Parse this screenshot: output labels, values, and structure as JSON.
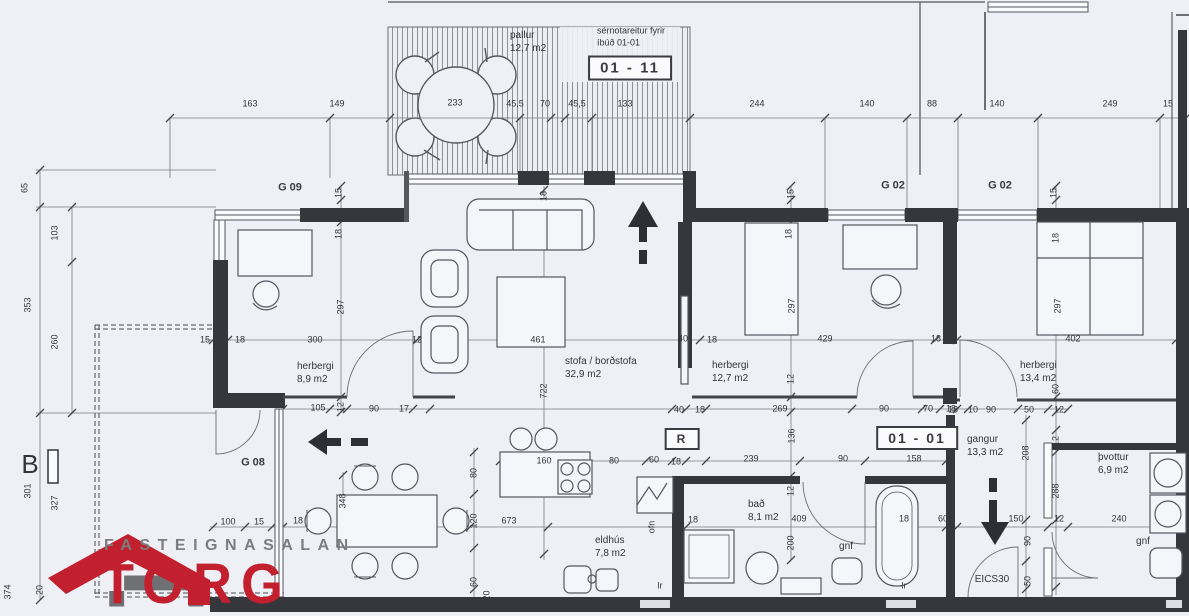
{
  "title": "Floor plan unit 01-01 / 01-11",
  "colors": {
    "paper": "#eef0f5",
    "ink": "#33343a",
    "wall": "#36373c",
    "thin": "#6b6e78",
    "red": "#c2202e",
    "gray": "#7c7d80"
  },
  "logo": {
    "name": "FASTEIGNASALAN",
    "brand": "TORG"
  },
  "deck": {
    "label": "pallur",
    "area": "12,7 m2",
    "note1": "sérnotareitur fyrir",
    "note2": "íbúð 01-01"
  },
  "badges": {
    "unit_top": "01 - 11",
    "unit_main": "01 - 01",
    "r_mark": "R"
  },
  "rooms": [
    {
      "name": "herbergi",
      "area": "8,9 m2"
    },
    {
      "name": "stofa / borðstofa",
      "area": "32,9 m2"
    },
    {
      "name": "herbergi",
      "area": "12,7 m2"
    },
    {
      "name": "herbergi",
      "area": "13,4 m2"
    },
    {
      "name": "eldhús",
      "area": "7,8 m2"
    },
    {
      "name": "bað",
      "area": "8,1 m2"
    },
    {
      "name": "gangur",
      "area": "13,3 m2"
    },
    {
      "name": "þvottur",
      "area": "6,9 m2"
    }
  ],
  "labels": [
    {
      "t": "pallur",
      "x": 510,
      "y": 36,
      "a": "left",
      "s": 10,
      "n": "deck-label"
    },
    {
      "t": "12,7 m2",
      "x": 510,
      "y": 49,
      "a": "left",
      "s": 10,
      "n": "deck-area"
    },
    {
      "t": "sérnotareitur fyrir",
      "x": 597,
      "y": 31,
      "a": "left",
      "n": "deck-note-line1"
    },
    {
      "t": "íbúð 01-01",
      "x": 597,
      "y": 43,
      "a": "left",
      "n": "deck-note-line2"
    },
    {
      "t": "01 - 11",
      "x": 630,
      "y": 68,
      "box": true,
      "s": 15,
      "b": true,
      "n": "unit-badge-01-11"
    },
    {
      "t": "233",
      "x": 455,
      "y": 103
    },
    {
      "t": "163",
      "x": 250,
      "y": 104
    },
    {
      "t": "149",
      "x": 337,
      "y": 104
    },
    {
      "t": "45,5",
      "x": 515,
      "y": 104
    },
    {
      "t": "70",
      "x": 545,
      "y": 104
    },
    {
      "t": "45,5",
      "x": 577,
      "y": 104
    },
    {
      "t": "133",
      "x": 625,
      "y": 104
    },
    {
      "t": "244",
      "x": 757,
      "y": 104
    },
    {
      "t": "140",
      "x": 867,
      "y": 104
    },
    {
      "t": "88",
      "x": 932,
      "y": 104
    },
    {
      "t": "140",
      "x": 997,
      "y": 104
    },
    {
      "t": "249",
      "x": 1110,
      "y": 104
    },
    {
      "t": "15",
      "x": 1168,
      "y": 104
    },
    {
      "t": "65",
      "x": 25,
      "y": 188,
      "r": true
    },
    {
      "t": "103",
      "x": 55,
      "y": 233,
      "r": true
    },
    {
      "t": "353",
      "x": 28,
      "y": 305,
      "r": true
    },
    {
      "t": "260",
      "x": 55,
      "y": 342,
      "r": true
    },
    {
      "t": "B",
      "x": 30,
      "y": 464,
      "s": 26,
      "n": "section-mark-b"
    },
    {
      "t": "301",
      "x": 28,
      "y": 491,
      "r": true
    },
    {
      "t": "327",
      "x": 55,
      "y": 503,
      "r": true
    },
    {
      "t": "374",
      "x": 8,
      "y": 592,
      "r": true
    },
    {
      "t": "20",
      "x": 40,
      "y": 590,
      "r": true
    },
    {
      "t": "120",
      "x": 487,
      "y": 598,
      "r": true
    },
    {
      "t": "G 09",
      "x": 290,
      "y": 188,
      "b": true,
      "s": 11,
      "n": "garden-label-g09"
    },
    {
      "t": "G 02",
      "x": 893,
      "y": 186,
      "b": true,
      "s": 11,
      "n": "garden-label-g02-a"
    },
    {
      "t": "G 02",
      "x": 1000,
      "y": 186,
      "b": true,
      "s": 11,
      "n": "garden-label-g02-b"
    },
    {
      "t": "G 08",
      "x": 253,
      "y": 463,
      "b": true,
      "s": 11,
      "n": "garden-label-g08"
    },
    {
      "t": "herbergi",
      "x": 297,
      "y": 367,
      "a": "left",
      "s": 10,
      "n": "room-label-herbergi-1"
    },
    {
      "t": "8,9 m2",
      "x": 297,
      "y": 380,
      "a": "left",
      "s": 10
    },
    {
      "t": "stofa / borðstofa",
      "x": 565,
      "y": 362,
      "a": "left",
      "s": 10,
      "n": "room-label-stofa"
    },
    {
      "t": "32,9 m2",
      "x": 565,
      "y": 375,
      "a": "left",
      "s": 10
    },
    {
      "t": "herbergi",
      "x": 712,
      "y": 366,
      "a": "left",
      "s": 10,
      "n": "room-label-herbergi-2"
    },
    {
      "t": "12,7 m2",
      "x": 712,
      "y": 379,
      "a": "left",
      "s": 10
    },
    {
      "t": "herbergi",
      "x": 1020,
      "y": 366,
      "a": "left",
      "s": 10,
      "n": "room-label-herbergi-3"
    },
    {
      "t": "13,4 m2",
      "x": 1020,
      "y": 379,
      "a": "left",
      "s": 10
    },
    {
      "t": "eldhús",
      "x": 595,
      "y": 541,
      "a": "left",
      "s": 10,
      "n": "room-label-eldhus"
    },
    {
      "t": "7,8 m2",
      "x": 595,
      "y": 554,
      "a": "left",
      "s": 10
    },
    {
      "t": "bað",
      "x": 748,
      "y": 505,
      "a": "left",
      "s": 10,
      "n": "room-label-bad"
    },
    {
      "t": "8,1 m2",
      "x": 748,
      "y": 518,
      "a": "left",
      "s": 10
    },
    {
      "t": "gangur",
      "x": 967,
      "y": 440,
      "a": "left",
      "s": 10,
      "n": "room-label-gangur"
    },
    {
      "t": "13,3 m2",
      "x": 967,
      "y": 453,
      "a": "left",
      "s": 10
    },
    {
      "t": "þvottur",
      "x": 1098,
      "y": 458,
      "a": "left",
      "s": 10,
      "n": "room-label-thvottur"
    },
    {
      "t": "6,9 m2",
      "x": 1098,
      "y": 471,
      "a": "left",
      "s": 10
    },
    {
      "t": "gnf",
      "x": 846,
      "y": 547,
      "s": 10,
      "n": "fixture-label-gnf-bath"
    },
    {
      "t": "gnf",
      "x": 1143,
      "y": 542,
      "s": 10,
      "n": "fixture-label-gnf-laundry"
    },
    {
      "t": "EICS30",
      "x": 992,
      "y": 580,
      "s": 10,
      "n": "door-spec-label"
    },
    {
      "t": "01 - 01",
      "x": 917,
      "y": 438,
      "box": true,
      "s": 14,
      "b": true,
      "n": "unit-badge-01-01"
    },
    {
      "t": "R",
      "x": 682,
      "y": 439,
      "box": true,
      "s": 12,
      "b": true,
      "n": "r-badge"
    },
    {
      "t": "ofn",
      "x": 652,
      "y": 527,
      "r": true,
      "n": "fixture-label-ofn"
    },
    {
      "t": "lr",
      "x": 660,
      "y": 586
    },
    {
      "t": "lr",
      "x": 904,
      "y": 586
    },
    {
      "t": "lr",
      "x": 1180,
      "y": 584,
      "r": true
    },
    {
      "t": "15",
      "x": 339,
      "y": 193,
      "r": true
    },
    {
      "t": "18",
      "x": 339,
      "y": 234,
      "r": true
    },
    {
      "t": "297",
      "x": 341,
      "y": 307,
      "r": true
    },
    {
      "t": "15",
      "x": 205,
      "y": 340
    },
    {
      "t": "18",
      "x": 240,
      "y": 340
    },
    {
      "t": "300",
      "x": 315,
      "y": 340
    },
    {
      "t": "12",
      "x": 417,
      "y": 340
    },
    {
      "t": "105",
      "x": 318,
      "y": 408
    },
    {
      "t": "12",
      "x": 341,
      "y": 407,
      "r": true
    },
    {
      "t": "90",
      "x": 374,
      "y": 409
    },
    {
      "t": "17",
      "x": 404,
      "y": 409
    },
    {
      "t": "18",
      "x": 544,
      "y": 196,
      "r": true
    },
    {
      "t": "461",
      "x": 538,
      "y": 340
    },
    {
      "t": "722",
      "x": 544,
      "y": 391,
      "r": true
    },
    {
      "t": "40",
      "x": 683,
      "y": 339
    },
    {
      "t": "15",
      "x": 791,
      "y": 194,
      "r": true
    },
    {
      "t": "18",
      "x": 789,
      "y": 234,
      "r": true
    },
    {
      "t": "297",
      "x": 792,
      "y": 306,
      "r": true
    },
    {
      "t": "18",
      "x": 712,
      "y": 340
    },
    {
      "t": "429",
      "x": 825,
      "y": 339
    },
    {
      "t": "18",
      "x": 936,
      "y": 339
    },
    {
      "t": "12",
      "x": 791,
      "y": 379,
      "r": true
    },
    {
      "t": "40",
      "x": 679,
      "y": 410
    },
    {
      "t": "18",
      "x": 700,
      "y": 410
    },
    {
      "t": "269",
      "x": 780,
      "y": 409
    },
    {
      "t": "90",
      "x": 884,
      "y": 409
    },
    {
      "t": "70",
      "x": 928,
      "y": 409
    },
    {
      "t": "18",
      "x": 951,
      "y": 409
    },
    {
      "t": "15",
      "x": 1054,
      "y": 193,
      "r": true
    },
    {
      "t": "18",
      "x": 1056,
      "y": 238,
      "r": true
    },
    {
      "t": "297",
      "x": 1058,
      "y": 306,
      "r": true
    },
    {
      "t": "402",
      "x": 1073,
      "y": 339
    },
    {
      "t": "60",
      "x": 1056,
      "y": 389,
      "r": true
    },
    {
      "t": "18",
      "x": 953,
      "y": 410
    },
    {
      "t": "10",
      "x": 973,
      "y": 410
    },
    {
      "t": "90",
      "x": 991,
      "y": 410
    },
    {
      "t": "50",
      "x": 1029,
      "y": 410
    },
    {
      "t": "12",
      "x": 1059,
      "y": 410
    },
    {
      "t": "100",
      "x": 228,
      "y": 522
    },
    {
      "t": "15",
      "x": 259,
      "y": 522
    },
    {
      "t": "18",
      "x": 298,
      "y": 521
    },
    {
      "t": "348",
      "x": 343,
      "y": 501,
      "r": true
    },
    {
      "t": "80",
      "x": 474,
      "y": 473,
      "r": true
    },
    {
      "t": "120",
      "x": 474,
      "y": 521,
      "r": true
    },
    {
      "t": "60",
      "x": 474,
      "y": 582,
      "r": true
    },
    {
      "t": "673",
      "x": 509,
      "y": 521
    },
    {
      "t": "160",
      "x": 544,
      "y": 461
    },
    {
      "t": "80",
      "x": 614,
      "y": 461
    },
    {
      "t": "60",
      "x": 654,
      "y": 460
    },
    {
      "t": "18",
      "x": 676,
      "y": 462
    },
    {
      "t": "18",
      "x": 693,
      "y": 520
    },
    {
      "t": "239",
      "x": 751,
      "y": 459
    },
    {
      "t": "90",
      "x": 843,
      "y": 459
    },
    {
      "t": "158",
      "x": 914,
      "y": 459
    },
    {
      "t": "136",
      "x": 792,
      "y": 436,
      "r": true
    },
    {
      "t": "12",
      "x": 791,
      "y": 491,
      "r": true
    },
    {
      "t": "409",
      "x": 799,
      "y": 519
    },
    {
      "t": "200",
      "x": 791,
      "y": 543,
      "r": true
    },
    {
      "t": "18",
      "x": 904,
      "y": 519
    },
    {
      "t": "60",
      "x": 943,
      "y": 519
    },
    {
      "t": "208",
      "x": 1026,
      "y": 453,
      "r": true
    },
    {
      "t": "12",
      "x": 1056,
      "y": 441,
      "r": true
    },
    {
      "t": "288",
      "x": 1056,
      "y": 491,
      "r": true
    },
    {
      "t": "150",
      "x": 1016,
      "y": 519
    },
    {
      "t": "12",
      "x": 1059,
      "y": 519
    },
    {
      "t": "240",
      "x": 1119,
      "y": 519
    },
    {
      "t": "90",
      "x": 1028,
      "y": 541,
      "r": true
    },
    {
      "t": "50",
      "x": 1028,
      "y": 581,
      "r": true
    }
  ]
}
